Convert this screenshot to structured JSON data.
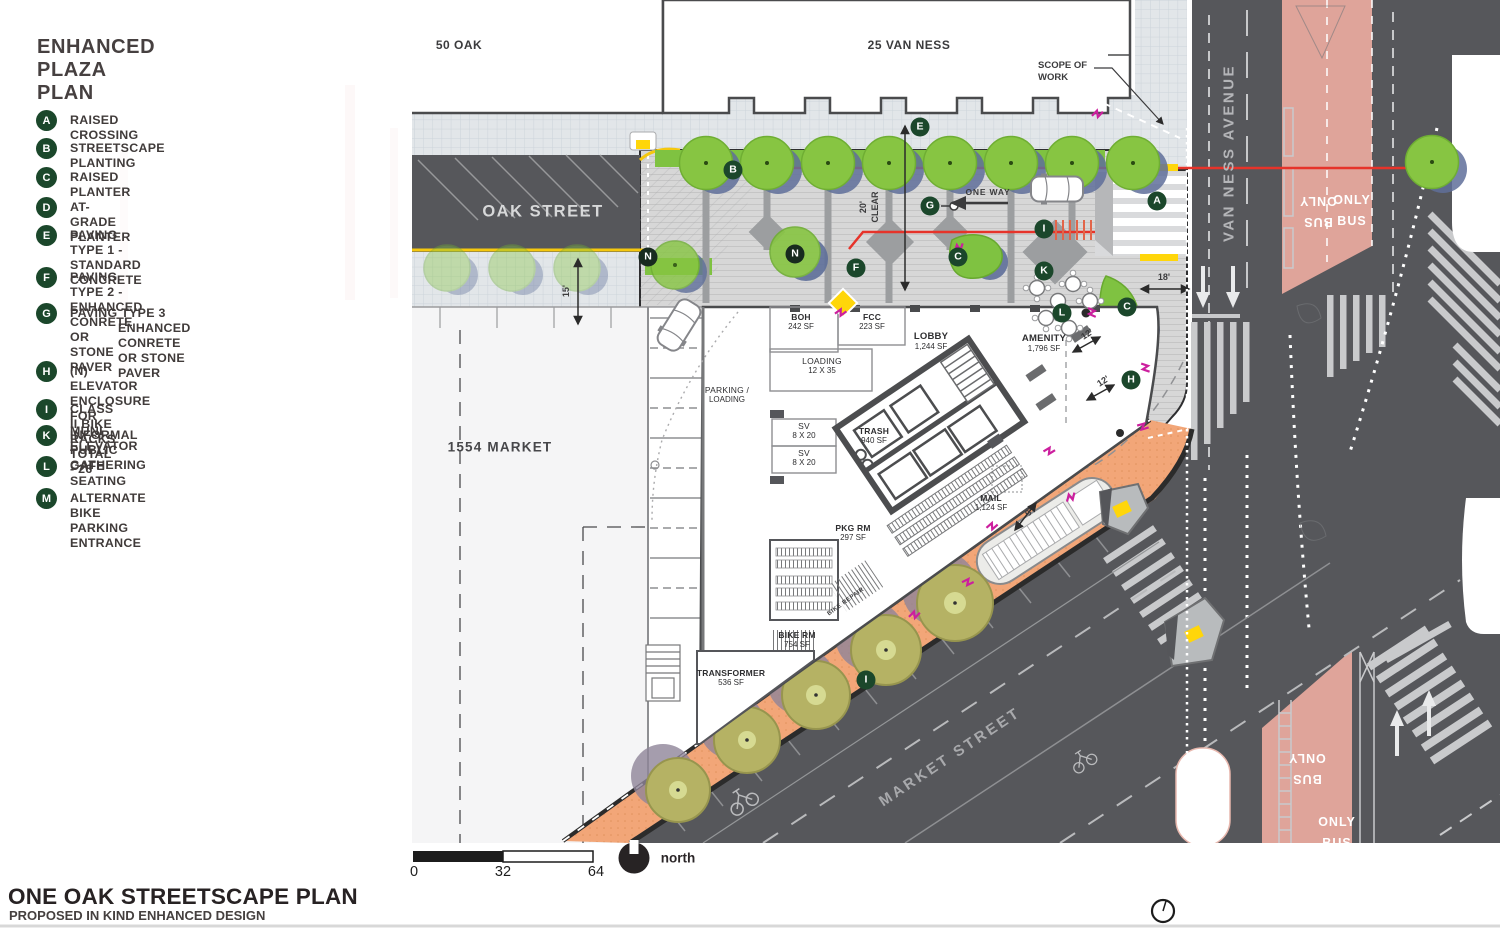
{
  "legend": {
    "title_line1": "ENHANCED",
    "title_line2": "PLAZA PLAN",
    "items": [
      {
        "letter": "A",
        "line1": "RAISED CROSSING"
      },
      {
        "letter": "B",
        "line1": "STREETSCAPE PLANTING"
      },
      {
        "letter": "C",
        "line1": "RAISED PLANTER"
      },
      {
        "letter": "D",
        "line1": "AT-GRADE PLANTER"
      },
      {
        "letter": "E",
        "line1": "PAVING TYPE 1 - STANDARD CONCRETE"
      },
      {
        "letter": "F",
        "line1": "PAVING TYPE 2 - ENHANCED CONRETE OR",
        "line2": "STONE PAVER"
      },
      {
        "letter": "G",
        "line1": "PAVING TYPE 3",
        "line2": "ENHANCED CONRETE",
        "line3": "OR STONE PAVER"
      },
      {
        "letter": "H",
        "line1": "(N) ELEVATOR ENCLOSURE FOR",
        "line2": "MUNI ELEVATOR"
      },
      {
        "letter": "I",
        "line1": "CLASS II BIKE RACKS TOTAL - 26"
      },
      {
        "letter": "K",
        "line1": "INFORMAL PUBLIC GATHERING"
      },
      {
        "letter": "L",
        "line1": "CAFE SEATING"
      },
      {
        "letter": "M",
        "line1": "ALTERNATE BIKE PARKING ENTRANCE"
      }
    ]
  },
  "buildings": {
    "fifty_oak": "50 OAK",
    "van_ness_25": "25 VAN NESS",
    "market_1554": "1554 MARKET"
  },
  "streets": {
    "oak": "OAK STREET",
    "van_ness": "VAN NESS AVENUE",
    "market": "MARKET STREET"
  },
  "annotations": {
    "scope_line1": "SCOPE OF",
    "scope_line2": "WORK",
    "one_way": "ONE WAY",
    "bike_repair": "BIKE REPAIR"
  },
  "dimensions": {
    "twenty": "20'",
    "clear": "CLEAR",
    "fifteen": "15'",
    "eighteen": "18'",
    "twelve_a": "12'",
    "twelve_b": "12'",
    "nine": "9'"
  },
  "rooms": [
    {
      "line1": "BOH",
      "line2": "242 SF"
    },
    {
      "line1": "FCC",
      "line2": "223 SF"
    },
    {
      "line1": "LOADING",
      "line2": "12 X 35"
    },
    {
      "line1": "PARKING /",
      "line2": "LOADING"
    },
    {
      "line1": "LOBBY",
      "line2": "1,244 SF"
    },
    {
      "line1": "AMENITY",
      "line2": "1,796 SF"
    },
    {
      "line1": "TRASH",
      "line2": "940 SF"
    },
    {
      "line1": "SV",
      "line2": "8 X 20"
    },
    {
      "line1": "SV",
      "line2": "8 X 20"
    },
    {
      "line1": "MAIL",
      "line2": "1,124 SF"
    },
    {
      "line1": "PKG RM",
      "line2": "297 SF"
    },
    {
      "line1": "BIKE RM",
      "line2": "754 SF"
    },
    {
      "line1": "TRANSFORMER",
      "line2": "536 SF"
    }
  ],
  "plan_markers": [
    "E",
    "B",
    "G",
    "A",
    "I",
    "N",
    "N",
    "F",
    "C",
    "K",
    "L",
    "C",
    "H",
    "I"
  ],
  "road_markings": {
    "bus": "BUS",
    "only": "ONLY"
  },
  "scale_bar": {
    "zero": "0",
    "thirty_two": "32",
    "sixty_four": "64",
    "north_label": "north"
  },
  "title_block": {
    "title": "ONE OAK STREETSCAPE PLAN",
    "subtitle": "PROPOSED IN KIND ENHANCED DESIGN"
  },
  "colors": {
    "legend_green": "#1b472b",
    "tree_green": "#87c542",
    "red_accent_line": "#e6332a",
    "market_sidewalk_orange": "#f2a678",
    "bus_lane_pink": "#dfa49a",
    "road_gray": "#56575b",
    "curb_yellow": "#ffd60a",
    "magenta_marker": "#cc1f9e"
  }
}
